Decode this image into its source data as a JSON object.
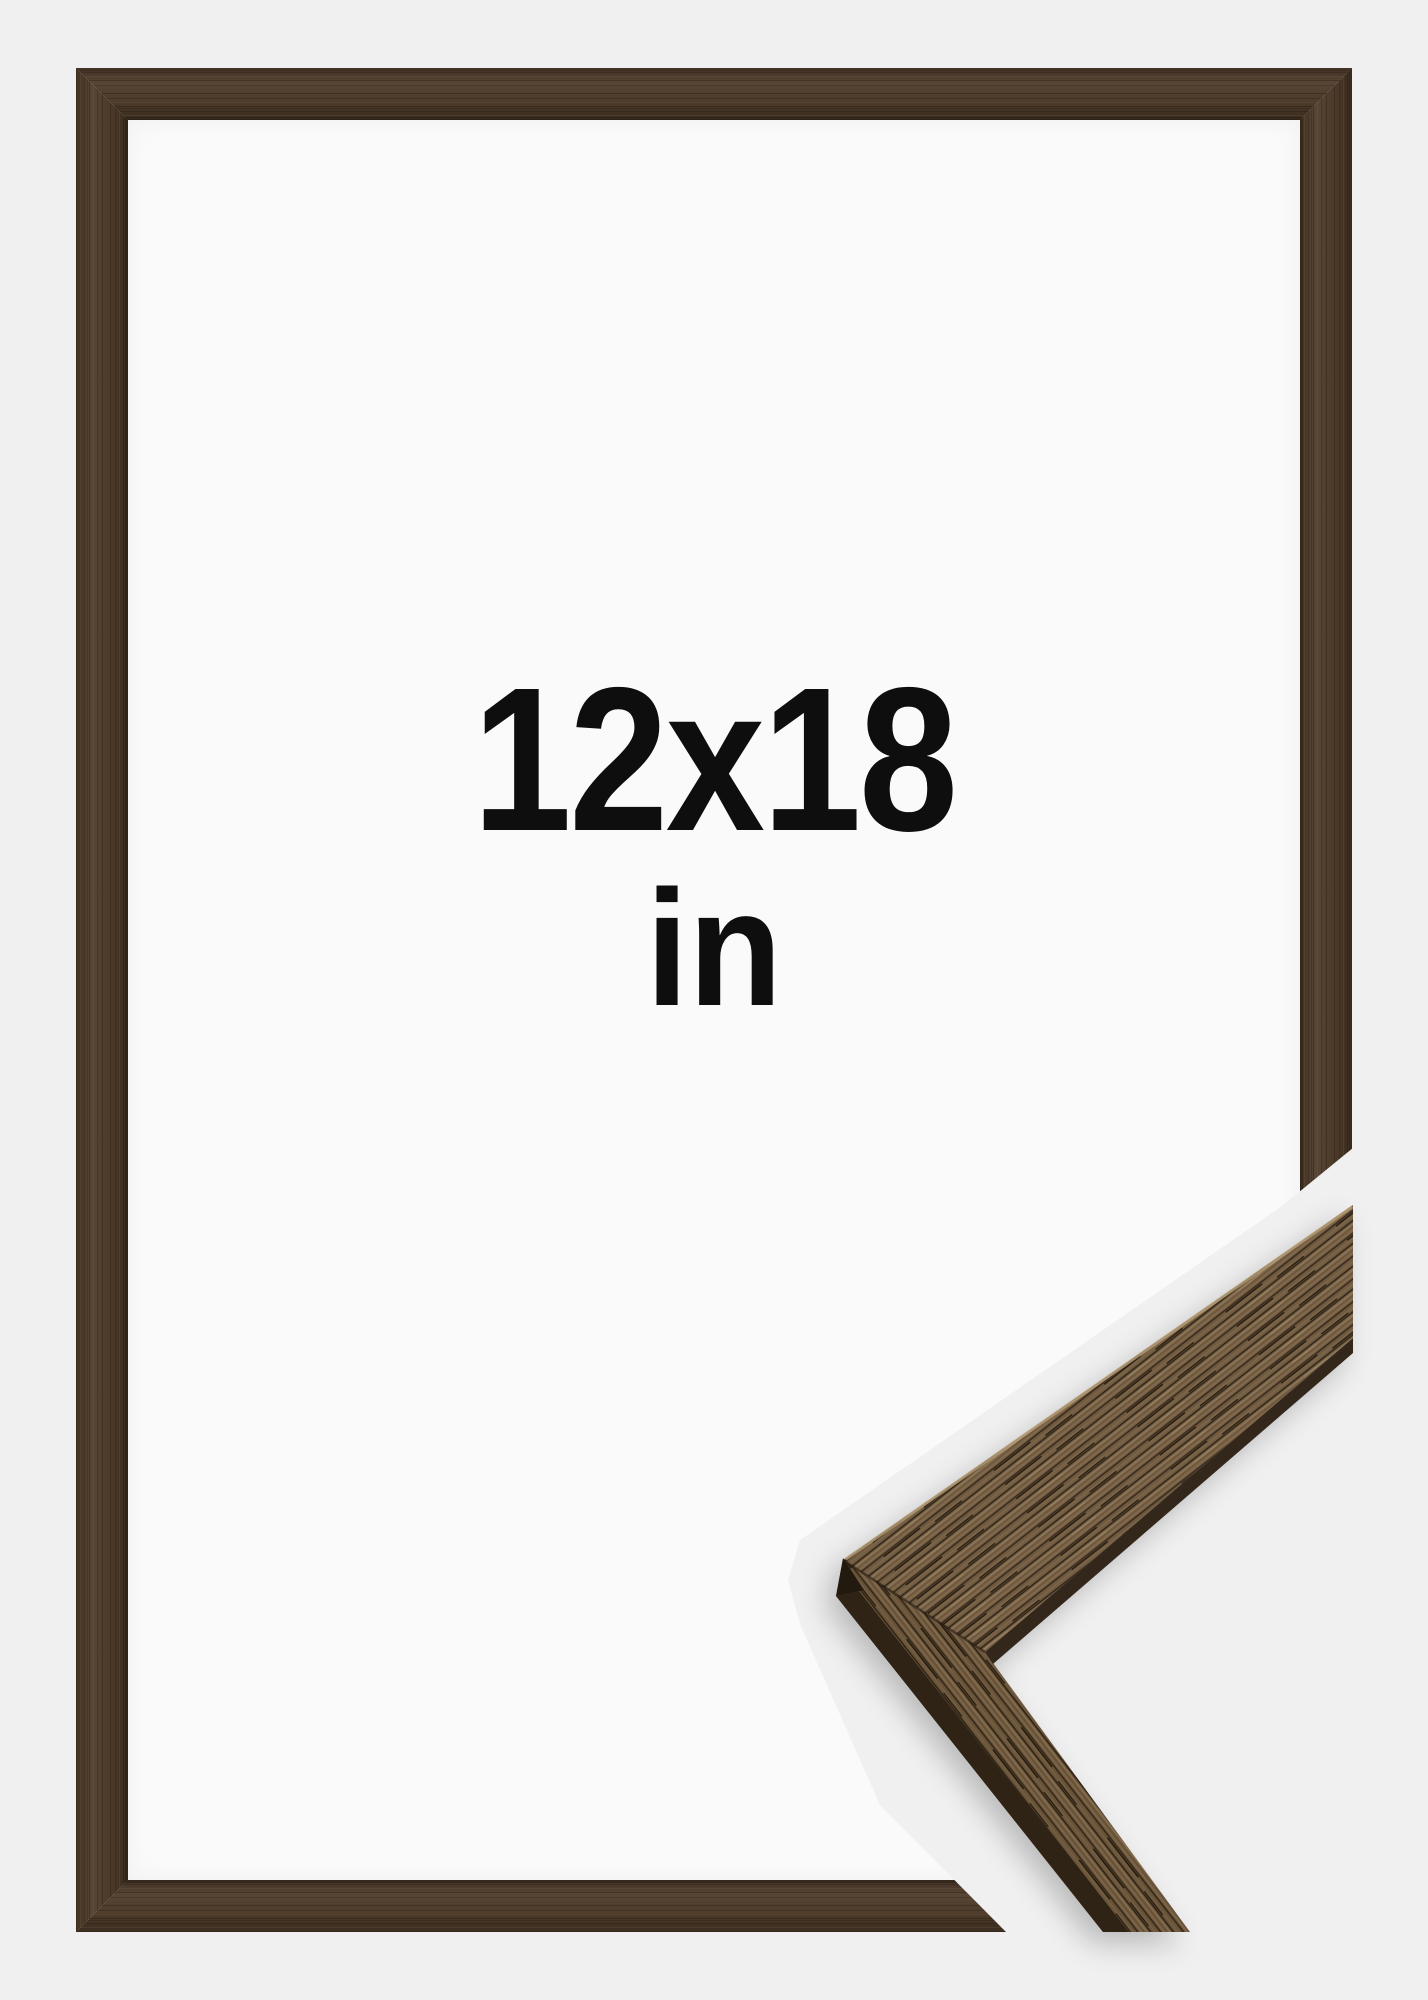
{
  "preview": {
    "size_label": "12x18",
    "unit_label": "in"
  },
  "frame": {
    "style": "thin-walnut-wood-frame",
    "colors": {
      "background": "#f0f0f1",
      "mat_white": "#fafafa",
      "frame_wood_base": "#4e3b2a",
      "frame_wood_dark_streak": "#2f2317",
      "frame_wood_light_streak": "#82694b",
      "sample_wood_base": "#6f5a41",
      "sample_wood_light_fleck": "#8d7656",
      "sample_wood_dark_streak": "#3a2c1d",
      "sample_side_face": "#2e2315",
      "text": "#0e0e0e"
    }
  }
}
